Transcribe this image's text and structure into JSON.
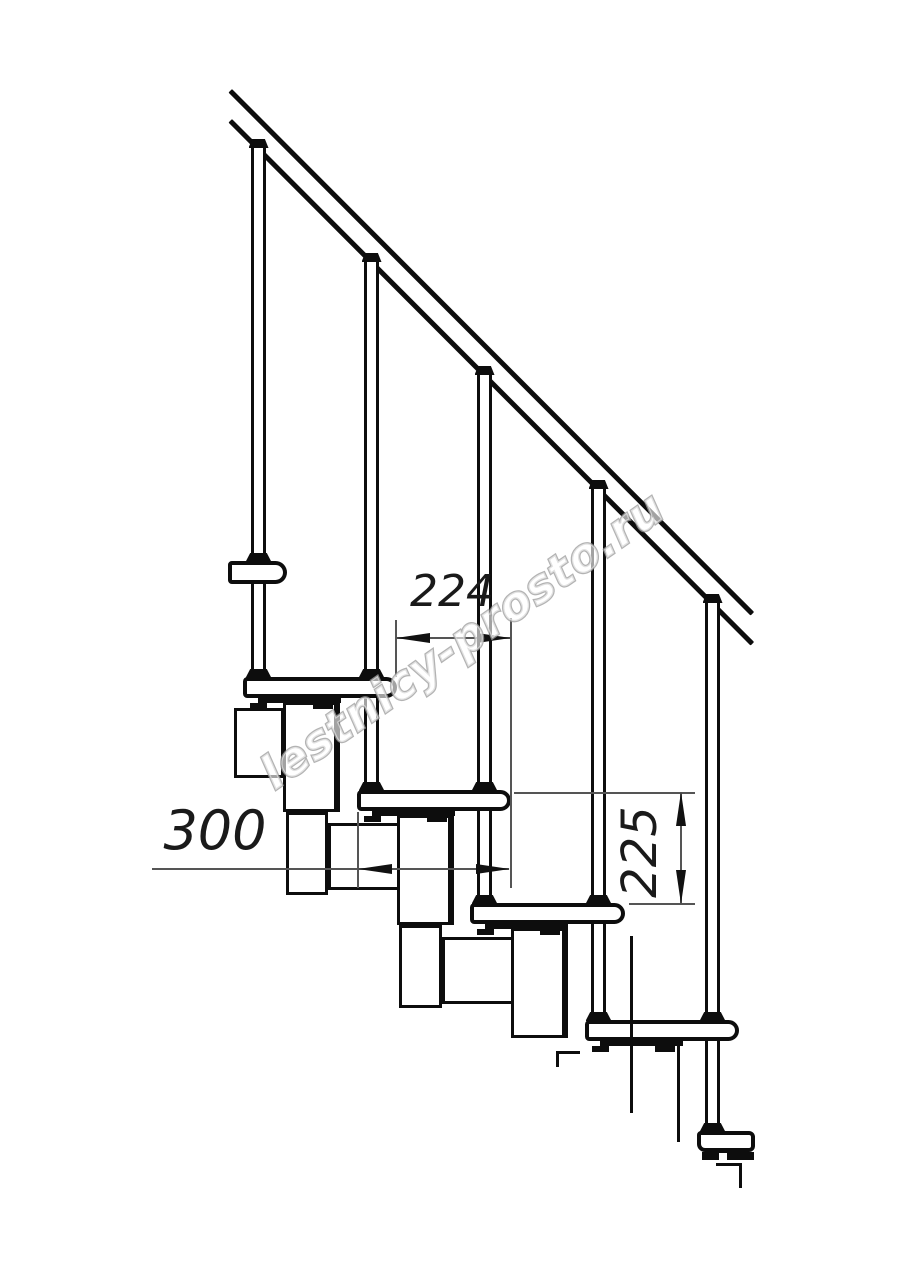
{
  "drawing": {
    "type": "staircase-technical-drawing",
    "watermark": {
      "text": "lestnicy-prosto.ru",
      "outline_color": "#9e9e9e",
      "fill_color": "#ffffff"
    },
    "colors": {
      "line": "#0d0d0d",
      "dimension": "#555555",
      "background": "#ffffff"
    },
    "dimensions": {
      "run": {
        "value": "224",
        "orientation": "horizontal",
        "meaning": "step-run-between-tread-edges"
      },
      "depth": {
        "value": "300",
        "orientation": "horizontal",
        "meaning": "tread-depth"
      },
      "rise": {
        "value": "225",
        "orientation": "vertical",
        "meaning": "step-rise-between-treads"
      }
    },
    "geometry": {
      "rails": [
        {
          "x": 232,
          "y": 89,
          "len": 739,
          "angle": 45.05,
          "t": 5
        },
        {
          "x": 232,
          "y": 119,
          "len": 739,
          "angle": 45.05,
          "t": 5
        }
      ],
      "posts": [
        {
          "x": 251,
          "w": 15,
          "top": 147,
          "bot": 677,
          "caps": [
            139,
            553,
            669
          ]
        },
        {
          "x": 364,
          "w": 15,
          "top": 261,
          "bot": 790,
          "caps": [
            253,
            669,
            782
          ]
        },
        {
          "x": 477,
          "w": 15,
          "top": 374,
          "bot": 903,
          "caps": [
            366,
            782,
            895
          ]
        },
        {
          "x": 591,
          "w": 15,
          "top": 488,
          "bot": 1020,
          "caps": [
            480,
            895,
            1012
          ]
        },
        {
          "x": 705,
          "w": 15,
          "top": 602,
          "bot": 1131,
          "caps": [
            594,
            1012,
            1123
          ]
        }
      ],
      "treads": [
        {
          "x": 228,
          "y": 561,
          "w": 59,
          "h": 23,
          "small": true
        },
        {
          "x": 243,
          "y": 677,
          "w": 154,
          "h": 21
        },
        {
          "x": 357,
          "y": 790,
          "w": 154,
          "h": 21
        },
        {
          "x": 470,
          "y": 903,
          "w": 155,
          "h": 21
        },
        {
          "x": 585,
          "y": 1020,
          "w": 154,
          "h": 21
        }
      ],
      "boxes": [
        {
          "x": 234,
          "y": 708,
          "w": 50,
          "h": 70,
          "thick": false
        },
        {
          "x": 283,
          "y": 702,
          "w": 57,
          "h": 110,
          "thick": true
        },
        {
          "x": 286,
          "y": 812,
          "w": 42,
          "h": 83,
          "thick": false
        },
        {
          "x": 328,
          "y": 823,
          "w": 75,
          "h": 67,
          "thick": false
        },
        {
          "x": 397,
          "y": 815,
          "w": 57,
          "h": 110,
          "thick": true
        },
        {
          "x": 399,
          "y": 925,
          "w": 43,
          "h": 83,
          "thick": false
        },
        {
          "x": 442,
          "y": 937,
          "w": 75,
          "h": 67,
          "thick": false
        },
        {
          "x": 511,
          "y": 928,
          "w": 57,
          "h": 110,
          "thick": true
        }
      ],
      "strips": [
        {
          "x": 258,
          "y": 698,
          "w": 83,
          "h": 5
        },
        {
          "x": 372,
          "y": 811,
          "w": 83,
          "h": 5
        },
        {
          "x": 485,
          "y": 924,
          "w": 83,
          "h": 5
        },
        {
          "x": 600,
          "y": 1041,
          "w": 83,
          "h": 5
        },
        {
          "x": 702,
          "y": 1152,
          "w": 52,
          "h": 8
        }
      ],
      "tabs": [
        {
          "x": 250,
          "y": 703,
          "w": 17,
          "h": 6
        },
        {
          "x": 313,
          "y": 703,
          "w": 20,
          "h": 6
        },
        {
          "x": 364,
          "y": 816,
          "w": 17,
          "h": 6
        },
        {
          "x": 427,
          "y": 816,
          "w": 20,
          "h": 6
        },
        {
          "x": 477,
          "y": 929,
          "w": 17,
          "h": 6
        },
        {
          "x": 540,
          "y": 929,
          "w": 20,
          "h": 6
        },
        {
          "x": 592,
          "y": 1046,
          "w": 17,
          "h": 6
        },
        {
          "x": 655,
          "y": 1046,
          "w": 20,
          "h": 6
        }
      ],
      "bracket": {
        "slab": {
          "x": 697,
          "y": 1131,
          "w": 58,
          "h": 21
        },
        "notch": {
          "x": 719,
          "y": 1153,
          "w": 8,
          "h": 7
        },
        "contour": [
          {
            "x": 716,
            "y": 1163,
            "w": 26,
            "h": 3
          },
          {
            "x": 739,
            "y": 1163,
            "w": 3,
            "h": 25
          }
        ]
      },
      "break_lines": [
        {
          "x": 630,
          "y": 936,
          "w": 3,
          "h": 177
        },
        {
          "x": 677,
          "y": 1041,
          "w": 3,
          "h": 101
        },
        {
          "x": 556,
          "y": 1051,
          "w": 24,
          "h": 3
        },
        {
          "x": 556,
          "y": 1051,
          "w": 3,
          "h": 16
        }
      ],
      "dim_lines": [
        {
          "x": 396,
          "y": 637,
          "w": 114,
          "h": 1.5
        },
        {
          "x": 395,
          "y": 620,
          "w": 1.5,
          "h": 57
        },
        {
          "x": 510,
          "y": 618,
          "w": 1.5,
          "h": 270
        },
        {
          "x": 152,
          "y": 868,
          "w": 357,
          "h": 1.5
        },
        {
          "x": 357,
          "y": 812,
          "w": 1.5,
          "h": 76
        },
        {
          "x": 680,
          "y": 792,
          "w": 1.5,
          "h": 112
        },
        {
          "x": 514,
          "y": 792,
          "w": 181,
          "h": 1.5
        },
        {
          "x": 629,
          "y": 903,
          "w": 66,
          "h": 1.5
        }
      ],
      "dim_arrows": [
        {
          "tx": 396,
          "ty": 638,
          "dir": "left"
        },
        {
          "tx": 511,
          "ty": 638,
          "dir": "right"
        },
        {
          "tx": 358,
          "ty": 869,
          "dir": "left"
        },
        {
          "tx": 510,
          "ty": 869,
          "dir": "right"
        },
        {
          "tx": 681,
          "ty": 792,
          "dir": "up"
        },
        {
          "tx": 681,
          "ty": 904,
          "dir": "down"
        }
      ]
    }
  }
}
